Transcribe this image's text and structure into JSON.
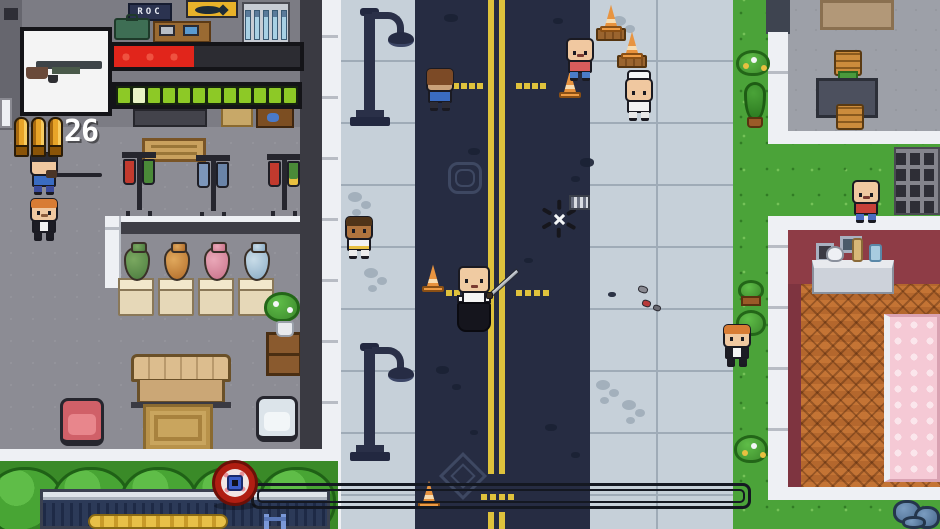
{
  "signs": {
    "roc_label": "ROC"
  },
  "hud": {
    "weapon_icon": "shotgun-icon",
    "ammo_count": "26",
    "bullet_count": 3,
    "health_percent": 43,
    "health_color": "#e1251b",
    "energy_segments": 12,
    "energy_pale_index": 1,
    "energy_color": "#8dc926",
    "objective_progress": 0,
    "marker_icon": "bomb-marker-icon"
  },
  "palette": {
    "road": "#262c42",
    "sidewalk": "#c6d0d9",
    "grass": "#4ba339",
    "hedge": "#48a534",
    "lane_line_yellow": "#dec23c",
    "building_floor": "#8c8c94",
    "wall_white": "#eef0f4",
    "wall_dark": "#3a3a42",
    "bedroom_wall_red": "#8e3c46",
    "wood_floor": "#b4672d",
    "bed_pink": "#f5c9d5",
    "cone_orange": "#e89440",
    "marker_red": "#b01e12"
  },
  "entities": {
    "characters": [
      {
        "name": "player-swordsman",
        "type": "player",
        "x": 456,
        "y": 266,
        "skin": "#f0cba2",
        "shirt": "#f4f4f4",
        "robe": "#15151d",
        "sword": true,
        "eyes": true,
        "mouth": "#7a3a30"
      },
      {
        "name": "pedestrian-brown-mop",
        "x": 424,
        "y": 68,
        "skin": "#caa27a",
        "hair": "#7c4a26",
        "hair_style": "mop",
        "shirt": "#3a6cc2",
        "pants": "#2c2c36",
        "eyes": false
      },
      {
        "name": "pedestrian-pink-shirt",
        "x": 564,
        "y": 38,
        "skin": "#f0c8a0",
        "shirt": "#d85c5c",
        "pants": "#4a7cc8",
        "eyes": true,
        "mouth": "#7a3a30"
      },
      {
        "name": "pedestrian-chef",
        "x": 623,
        "y": 70,
        "skin": "#f0c8a0",
        "hat": "chef",
        "shirt": "#f2f2f2",
        "pants": "#e8e8e8",
        "eyes": true
      },
      {
        "name": "pedestrian-white-shirt",
        "x": 343,
        "y": 216,
        "skin": "#b0743e",
        "hair": "#503418",
        "hair_style": "top",
        "shirt": "#f2f2f2",
        "pants": "#ececec",
        "belt": "#e8c040",
        "eyes": true
      },
      {
        "name": "pedestrian-suit-left",
        "x": 28,
        "y": 198,
        "skin": "#f0c8a0",
        "hair": "#d87c34",
        "hair_style": "top",
        "shirt": "#1c1c24",
        "suit_front": "#f4f4f4",
        "pants": "#1c1c24",
        "eyes": true,
        "mouth": "#8a5a3a"
      },
      {
        "name": "gunman-blue",
        "x": 28,
        "y": 152,
        "skin": "#f0c8a0",
        "hair": "#2a2a32",
        "hair_style": "top",
        "shirt": "#3a6cc2",
        "pants": "#3a4a9c",
        "rifle": true,
        "eyes": false
      },
      {
        "name": "pedestrian-suit-right",
        "x": 721,
        "y": 324,
        "skin": "#f0c8a0",
        "hair": "#d87c34",
        "hair_style": "top",
        "shirt": "#1c1c24",
        "suit_front": "#f4f4f4",
        "pants": "#1c1c24",
        "eyes": true
      },
      {
        "name": "pedestrian-red-shirt-bald",
        "x": 850,
        "y": 180,
        "skin": "#f0c8a0",
        "shirt": "#c84038",
        "pants": "#4a6cc0",
        "eyes": true,
        "mouth": "#7a3a30"
      }
    ],
    "cones": [
      {
        "x": 599,
        "y": 4,
        "pallet": true
      },
      {
        "x": 620,
        "y": 31,
        "pallet": true
      },
      {
        "x": 558,
        "y": 70
      },
      {
        "x": 421,
        "y": 264
      },
      {
        "x": 417,
        "y": 480
      }
    ],
    "lamps": [
      {
        "x": 348,
        "y": 6
      },
      {
        "x": 348,
        "y": 341
      }
    ],
    "dash_groups": [
      {
        "x": 453,
        "y": 83,
        "n": 4,
        "dx": 8
      },
      {
        "x": 516,
        "y": 83,
        "n": 4,
        "dx": 8
      },
      {
        "x": 446,
        "y": 290,
        "n": 4,
        "dx": 8
      },
      {
        "x": 516,
        "y": 290,
        "n": 4,
        "dx": 9
      },
      {
        "x": 481,
        "y": 494,
        "n": 4,
        "dx": 9
      }
    ],
    "road_spots": [
      {
        "x": 444,
        "y": 14,
        "w": 14,
        "h": 8
      },
      {
        "x": 553,
        "y": 18,
        "w": 10,
        "h": 6
      },
      {
        "x": 468,
        "y": 148,
        "w": 12,
        "h": 7
      },
      {
        "x": 580,
        "y": 158,
        "w": 14,
        "h": 9
      },
      {
        "x": 571,
        "y": 176,
        "w": 9,
        "h": 6
      },
      {
        "x": 436,
        "y": 366,
        "w": 13,
        "h": 8
      },
      {
        "x": 452,
        "y": 384,
        "w": 9,
        "h": 6
      },
      {
        "x": 545,
        "y": 424,
        "w": 12,
        "h": 7
      },
      {
        "x": 571,
        "y": 452,
        "w": 9,
        "h": 6
      },
      {
        "x": 608,
        "y": 292,
        "w": 8,
        "h": 5
      },
      {
        "x": 524,
        "y": 258,
        "w": 9,
        "h": 5
      },
      {
        "x": 470,
        "y": 430,
        "w": 8,
        "h": 5
      }
    ],
    "smudges": [
      {
        "x": 348,
        "y": 192
      },
      {
        "x": 364,
        "y": 268
      },
      {
        "x": 596,
        "y": 380
      },
      {
        "x": 622,
        "y": 400
      },
      {
        "x": 612,
        "y": 16
      }
    ],
    "debris": [
      {
        "x": 638,
        "y": 286,
        "w": 10,
        "h": 7,
        "c": "#8a8a92"
      },
      {
        "x": 642,
        "y": 300,
        "w": 9,
        "h": 7,
        "c": "#b83a3a"
      },
      {
        "x": 653,
        "y": 305,
        "w": 8,
        "h": 6,
        "c": "#6a6a72"
      }
    ],
    "pickup": {
      "crosshair": {
        "x": 540,
        "y": 200
      },
      "clip": {
        "x": 569,
        "y": 195
      }
    }
  }
}
